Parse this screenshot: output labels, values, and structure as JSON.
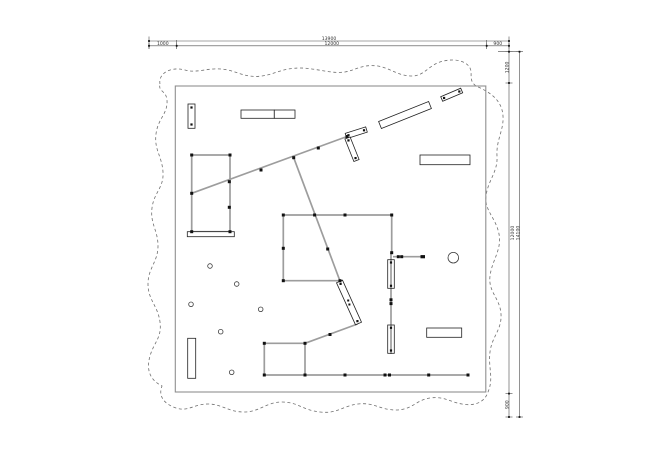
{
  "drawing": {
    "title": "floor-plan-with-revision-cloud",
    "colors": {
      "background": "#ffffff",
      "structure_gray": "#9d9d9d",
      "outline_black": "#222222",
      "node_black": "#111111",
      "dim_line": "#4a4a4a",
      "dim_text": "#333333",
      "cloud_dash": "#6f6f6f",
      "frame_gray": "#8f8f8f"
    },
    "dimensions": {
      "top": {
        "overall": "13900",
        "segments": [
          "1000",
          "12000",
          "900"
        ]
      },
      "right": {
        "overall": "14100",
        "segments": [
          "1200",
          "12000",
          "900"
        ]
      }
    },
    "geometry": {
      "frame": {
        "x": 175.3,
        "y": 86,
        "w": 310.5,
        "h": 306
      },
      "cloud_path": "M 160 84 C 158 74 170 66 185 70 C 198 74 210 66 228 70 C 240 73 248 78 262 76 C 276 74 282 68 300 68 C 316 68 330 74 345 72 C 356 70 362 64 378 66 C 390 68 398 76 412 76 C 424 76 428 66 440 62 C 452 58 466 60 470 68 C 473 74 468 80 476 86 C 490 92 502 100 503 116 C 504 130 496 140 497 156 C 498 172 488 180 486 196 C 484 210 496 218 499 234 C 502 250 492 260 490 276 C 488 292 500 298 501 314 C 502 330 492 336 490 352 C 488 368 494 378 488 392 C 484 404 472 406 462 404 C 450 402 444 396 430 398 C 416 400 412 410 396 410 C 380 410 374 402 358 404 C 342 406 338 414 320 412 C 302 410 298 402 282 402 C 266 402 260 412 244 412 C 228 412 222 404 208 404 C 194 404 188 412 176 408 C 164 404 158 396 162 386 C 150 380 146 370 150 356 C 154 342 162 338 160 322 C 158 306 148 300 148 284 C 148 268 158 262 158 246 C 158 230 150 224 152 208 C 154 192 164 188 163 172 C 162 156 154 150 156 134 C 158 118 168 114 167 100 C 166 90 158 92 160 84 Z",
      "gray_lines": [
        [
          191.7,
          193.3,
          347,
          136.5
        ],
        [
          293.7,
          157.7,
          340,
          281
        ],
        [
          191.7,
          155,
          230,
          155
        ],
        [
          230,
          155,
          230,
          231.7
        ],
        [
          230,
          231.7,
          191.7,
          231.7
        ],
        [
          191.7,
          231.7,
          191.7,
          155
        ],
        [
          283.3,
          215,
          391.7,
          215
        ],
        [
          283.3,
          215,
          283.3,
          280.7
        ],
        [
          283.3,
          280.7,
          340,
          280.7
        ],
        [
          391.7,
          215,
          391.7,
          252.7
        ],
        [
          391,
          252.7,
          391,
          354
        ],
        [
          393,
          256.7,
          420.5,
          256.7
        ],
        [
          264.3,
          343.3,
          305,
          343.3
        ],
        [
          264.3,
          343.3,
          264.3,
          375
        ],
        [
          305,
          343.3,
          305,
          375
        ],
        [
          264.3,
          375,
          468.3,
          375
        ],
        [
          305,
          343.3,
          357.5,
          324
        ],
        [
          191.5,
          105,
          191.5,
          127
        ]
      ],
      "nodes": [
        [
          191.7,
          155
        ],
        [
          230,
          155
        ],
        [
          191.7,
          231.7
        ],
        [
          230,
          231.7
        ],
        [
          191.7,
          193.3
        ],
        [
          229.3,
          181.7
        ],
        [
          229.3,
          207.3
        ],
        [
          261,
          170
        ],
        [
          293.7,
          157.7
        ],
        [
          318.3,
          148
        ],
        [
          347,
          136.5
        ],
        [
          283.3,
          215
        ],
        [
          391.7,
          215
        ],
        [
          283.3,
          280.7
        ],
        [
          345,
          215
        ],
        [
          314.6,
          215
        ],
        [
          283.3,
          248.3
        ],
        [
          327.7,
          249
        ],
        [
          340,
          280.7
        ],
        [
          391.7,
          252.7
        ],
        [
          264.3,
          343.3
        ],
        [
          305,
          343.3
        ],
        [
          264.3,
          375
        ],
        [
          305,
          375
        ],
        [
          330,
          334.5
        ],
        [
          345,
          375
        ],
        [
          385,
          375
        ],
        [
          389.5,
          375
        ],
        [
          428.7,
          375
        ],
        [
          468,
          375
        ],
        [
          391,
          299.8
        ],
        [
          391,
          303.6
        ],
        [
          398.3,
          256.7
        ],
        [
          401.7,
          256.7
        ]
      ],
      "bars": [
        [
          420.5,
          255.1,
          4.5,
          3.2
        ]
      ],
      "outline_rects": [
        {
          "x": 188,
          "y": 104,
          "w": 7,
          "h": 24.3,
          "fill": "#ffffff",
          "dots": [
            [
              191.5,
              107.5
            ],
            [
              191.5,
              124.5
            ]
          ]
        },
        {
          "x": 241,
          "y": 110,
          "w": 33.3,
          "h": 8.3,
          "fill": "#ffffff"
        },
        {
          "x": 274.3,
          "y": 110,
          "w": 20.7,
          "h": 8.3,
          "fill": "#ffffff"
        },
        {
          "x": 420,
          "y": 155,
          "w": 50,
          "h": 9.7,
          "fill": "#ffffff"
        },
        {
          "x": 426.7,
          "y": 328,
          "w": 35,
          "h": 9.3,
          "fill": "#ffffff"
        },
        {
          "x": 187.7,
          "y": 338.3,
          "w": 8,
          "h": 40,
          "fill": "#ffffff"
        },
        {
          "x": 187.3,
          "y": 231.7,
          "w": 47,
          "h": 5,
          "fill": "#ffffff"
        },
        {
          "x": 387.7,
          "y": 259.7,
          "w": 6.6,
          "h": 28.6,
          "fill": "none",
          "dots": [
            [
              391,
              262.5
            ],
            [
              391,
              285.8
            ]
          ]
        },
        {
          "x": 387.7,
          "y": 325,
          "w": 6.6,
          "h": 28.3,
          "fill": "none",
          "dots": [
            [
              391,
              327.8
            ],
            [
              391,
              350.5
            ]
          ]
        }
      ],
      "rot_rects": [
        {
          "x1": 380,
          "y1": 125,
          "x2": 430,
          "y2": 105,
          "w": 7.5,
          "dots": false
        },
        {
          "x1": 441.7,
          "y1": 99,
          "x2": 461.7,
          "y2": 90.5,
          "w": 5,
          "dots": true
        },
        {
          "x1": 346,
          "y1": 136,
          "x2": 366.5,
          "y2": 129.5,
          "w": 5.5,
          "dots": true
        },
        {
          "x1": 347.5,
          "y1": 138,
          "x2": 356.5,
          "y2": 160.5,
          "w": 5.5,
          "dots": true
        },
        {
          "x1": 339.5,
          "y1": 281.5,
          "x2": 358.5,
          "y2": 323.5,
          "w": 6.5,
          "dots": true,
          "mid": [
            [
              348.2,
              300.5
            ],
            [
              349.4,
              304.5
            ]
          ]
        }
      ],
      "circles": [
        [
          210,
          266,
          2.3
        ],
        [
          236.7,
          284,
          2.3
        ],
        [
          191,
          304.3,
          2.3
        ],
        [
          260.7,
          309.3,
          2.3
        ],
        [
          220.7,
          331.7,
          2.3
        ],
        [
          231.7,
          372.3,
          2.3
        ],
        [
          453.3,
          257.7,
          5.3
        ]
      ],
      "dim_top": {
        "line_overall": [
          149,
          41,
          509,
          41
        ],
        "line_segments": [
          149,
          45.8,
          509,
          45.8
        ],
        "seg_ticks_x": [
          149,
          176.7,
          486.7,
          509
        ],
        "overall_ticks_x": [
          149,
          509
        ],
        "ext_lines": [
          [
            149,
            36.5,
            149,
            49
          ],
          [
            176.7,
            40,
            176.7,
            49
          ],
          [
            486.7,
            40,
            486.7,
            49
          ],
          [
            509,
            36.5,
            509,
            51.7
          ]
        ]
      },
      "dim_right": {
        "line_inner": [
          509,
          51.7,
          509,
          417
        ],
        "line_outer": [
          519.5,
          51.7,
          519.5,
          417
        ],
        "connector": [
          498,
          51.7,
          519.5,
          51.7
        ],
        "inner_ticks_y": [
          51.7,
          83,
          393.6,
          417
        ],
        "outer_ticks_y": [
          51.7,
          417
        ]
      }
    }
  }
}
